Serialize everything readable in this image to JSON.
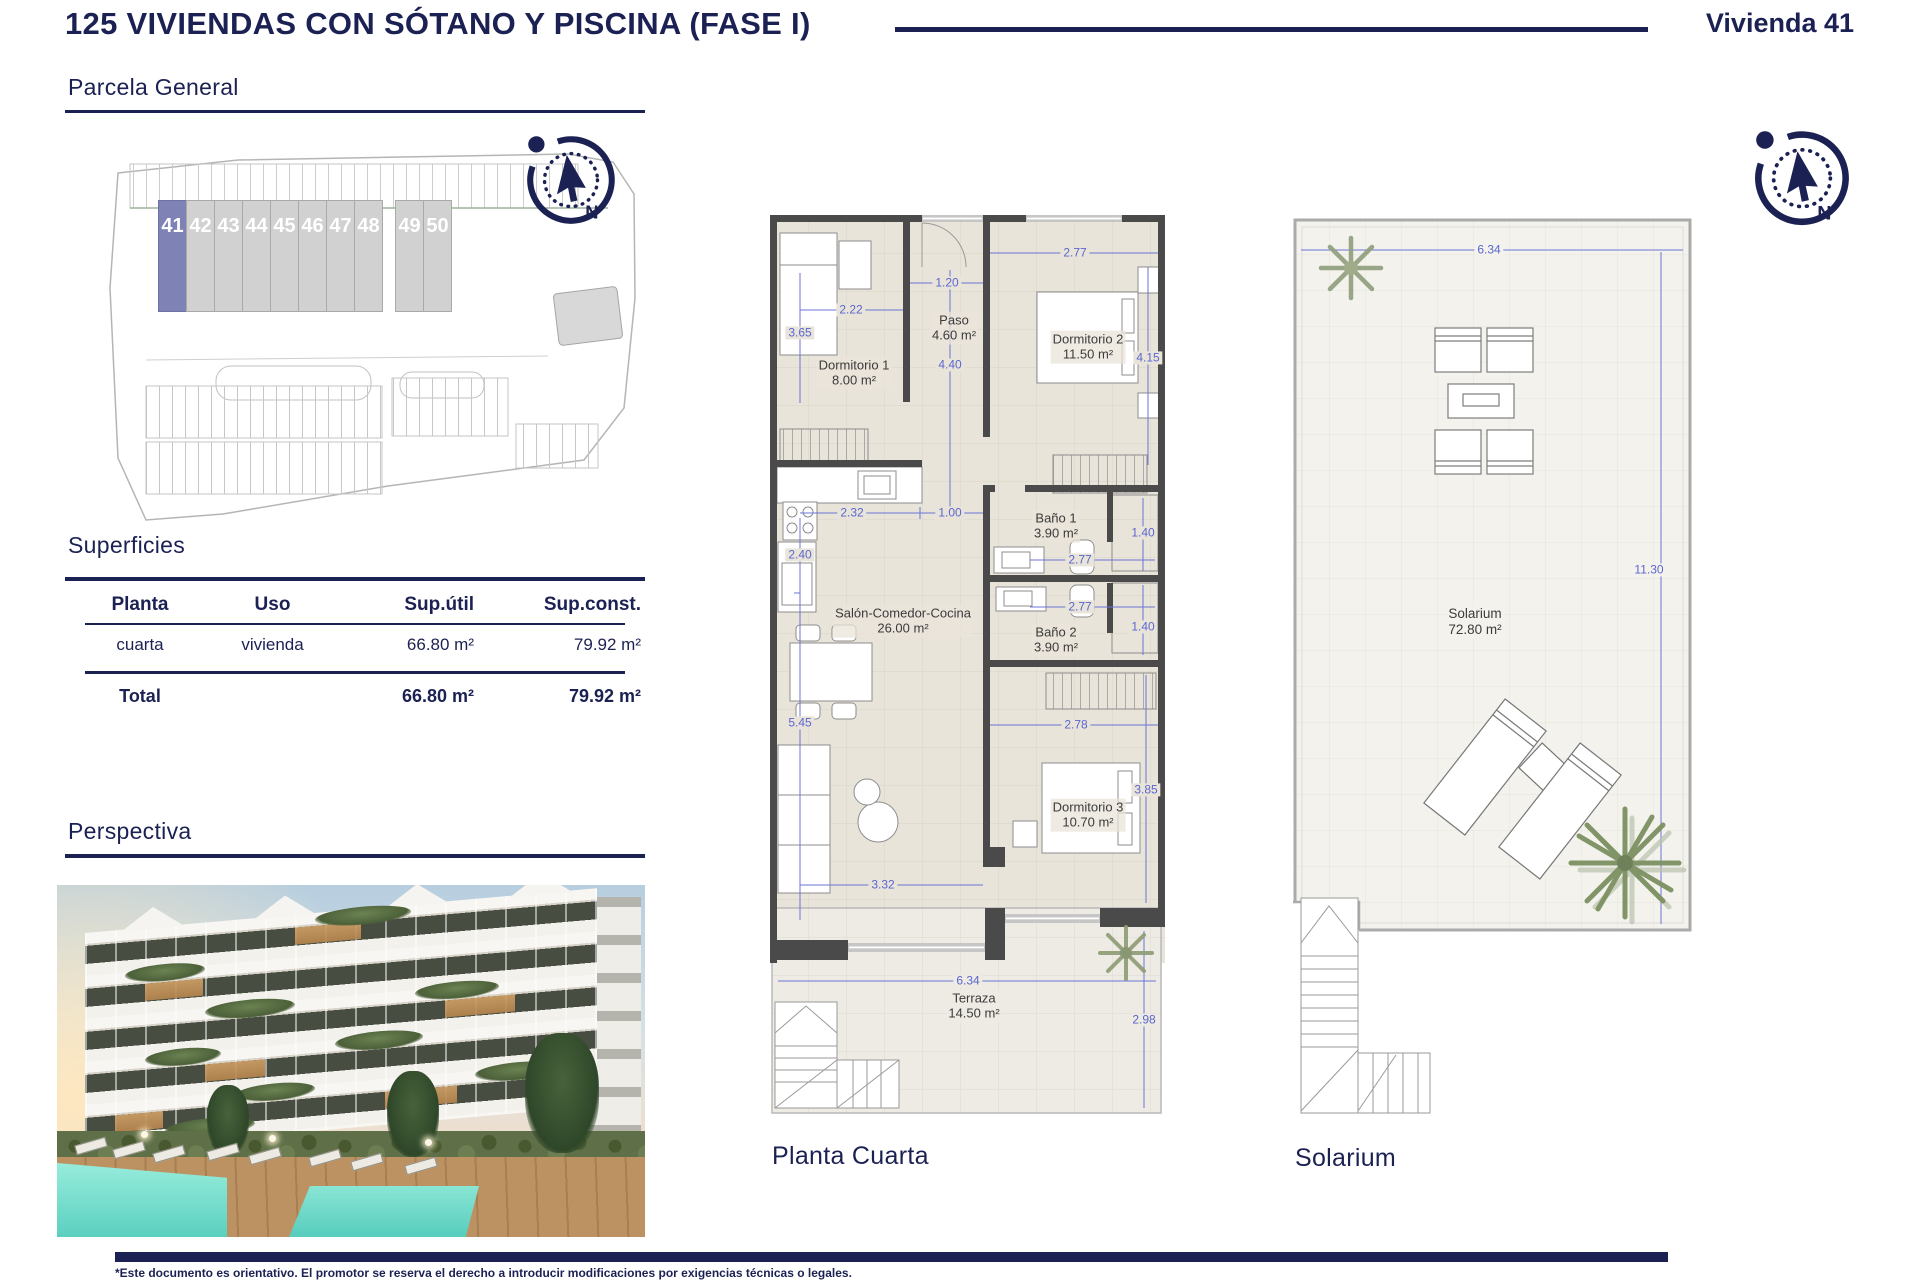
{
  "header": {
    "title": "125 VIVIENDAS CON SÓTANO Y PISCINA (FASE I)",
    "unit": "Vivienda 41"
  },
  "sections": {
    "parcela": "Parcela General",
    "superficies": "Superficies",
    "perspectiva": "Perspectiva"
  },
  "parcela": {
    "units": [
      "41",
      "42",
      "43",
      "44",
      "45",
      "46",
      "47",
      "48",
      "49",
      "50"
    ],
    "highlighted_unit": "41",
    "highlight_color": "#7e82b4"
  },
  "superficies": {
    "columns": [
      "Planta",
      "Uso",
      "Sup.útil",
      "Sup.const."
    ],
    "rows": [
      [
        "cuarta",
        "vivienda",
        "66.80 m²",
        "79.92 m²"
      ]
    ],
    "total_label": "Total",
    "total_util": "66.80 m²",
    "total_const": "79.92 m²"
  },
  "floorplan": {
    "caption": "Planta Cuarta",
    "rooms": [
      {
        "name": "Dormitorio 1",
        "area": "8.00 m²"
      },
      {
        "name": "Paso",
        "area": "4.60 m²"
      },
      {
        "name": "Dormitorio 2",
        "area": "11.50 m²"
      },
      {
        "name": "Baño 1",
        "area": "3.90 m²"
      },
      {
        "name": "Salón-Comedor-Cocina",
        "area": "26.00 m²"
      },
      {
        "name": "Baño 2",
        "area": "3.90 m²"
      },
      {
        "name": "Dormitorio 3",
        "area": "10.70 m²"
      },
      {
        "name": "Terraza",
        "area": "14.50 m²"
      }
    ],
    "dims": [
      "3.65",
      "2.22",
      "1.20",
      "4.40",
      "2.77",
      "4.15",
      "2.32",
      "1.00",
      "2.40",
      "1.40",
      "2.77",
      "2.77",
      "1.40",
      "5.45",
      "2.78",
      "3.85",
      "3.32",
      "6.34",
      "2.98"
    ]
  },
  "solarium": {
    "caption": "Solarium",
    "name": "Solarium",
    "area": "72.80 m²",
    "dims": [
      "6.34",
      "11.30"
    ]
  },
  "compass": {
    "n": "N"
  },
  "colors": {
    "accent": "#1b2153",
    "dims": "#5b66cf",
    "walls": "#4a4a4a"
  },
  "footer": {
    "disclaimer": "*Este documento es orientativo. El promotor se reserva el derecho a introducir modificaciones por exigencias técnicas o legales."
  }
}
